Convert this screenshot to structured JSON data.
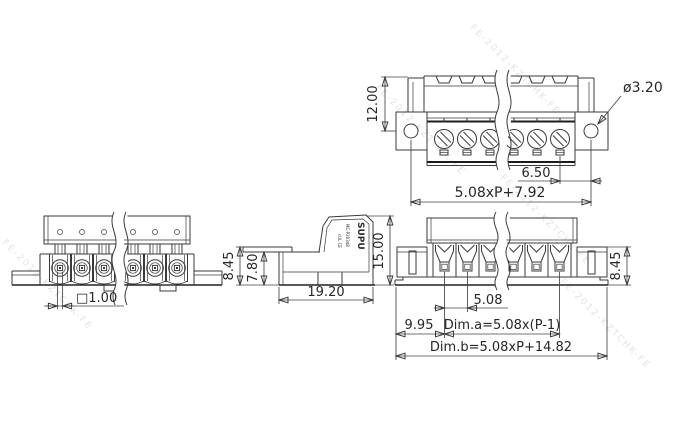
{
  "drawing": {
    "background": "#ffffff",
    "line_color": "#3a3a3a",
    "watermark": {
      "text": "FE-2012-KZTCHK-FE"
    }
  },
  "views": {
    "top": {
      "dims": {
        "height": "12.00",
        "hole_dia": "ø3.20",
        "hole_offset": "6.50",
        "mount_span": "5.08xP+7.92"
      }
    },
    "front": {
      "dims": {
        "square_hole": "□1.00"
      }
    },
    "side": {
      "dims": {
        "rear_height": "8.45",
        "body_height": "7.80",
        "depth": "19.20",
        "total_height": "15.00"
      },
      "marking": {
        "brand": "SUPU",
        "model": "MC-P20348",
        "certs": "cUL CE"
      }
    },
    "plug": {
      "dims": {
        "pitch": "5.08",
        "end_offset": "9.95",
        "dim_a": "Dim.a=5.08x(P-1)",
        "dim_b": "Dim.b=5.08xP+14.82",
        "height": "8.45"
      }
    }
  }
}
